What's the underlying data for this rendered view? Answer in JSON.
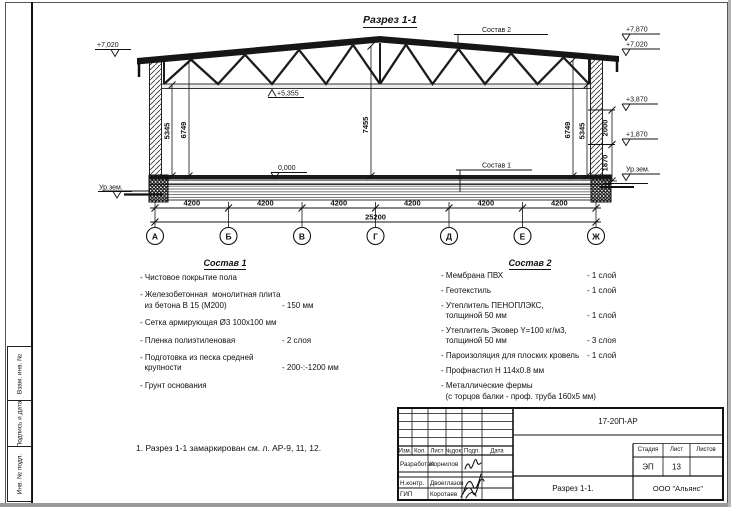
{
  "sheet": {
    "title": "Разрез 1-1",
    "note": "1. Разрез 1-1 замаркирован см. л. АР-9, 11, 12."
  },
  "margin_labels": {
    "vzam": "Взам. инв. №",
    "podpis": "Подпись и дата",
    "inv": "Инв. № подл."
  },
  "drawing": {
    "elevations": {
      "left_top": "+7,020",
      "left_ground": "Ур.зем.",
      "truss_bottom": "+5,355",
      "floor": "0,000",
      "right_ridge": "+7,870",
      "right_eave": "+7,020",
      "right_joint_upper": "+3,870",
      "right_joint_lower": "+1,870",
      "right_ground": "Ур.зем."
    },
    "callouts": {
      "roof": "Состав 2",
      "floor": "Состав 1"
    },
    "vdims": {
      "left_inner": "5345",
      "left_outer": "6749",
      "center": "7455",
      "right_outer": "6749",
      "right_inner": "5345",
      "wall_upper": "2000",
      "wall_lower": "1870"
    },
    "bays": [
      "4200",
      "4200",
      "4200",
      "4200",
      "4200",
      "4200"
    ],
    "total": "25200",
    "axes": [
      "А",
      "Б",
      "В",
      "Г",
      "Д",
      "Е",
      "Ж"
    ]
  },
  "sostav1": {
    "title": "Состав 1",
    "items": [
      {
        "name": "- Чистовое покрытие пола",
        "value": ""
      },
      {
        "name": "- Железобетонная  монолитная плита\n  из бетона В 15 (М200)",
        "value": "- 150 мм"
      },
      {
        "name": "- Сетка армирующая Ø3 100х100 мм",
        "value": ""
      },
      {
        "name": "- Пленка полиэтиленовая",
        "value": "- 2 слоя"
      },
      {
        "name": "- Подготовка из песка средней\n  крупности",
        "value": "- 200-:-1200 мм"
      },
      {
        "name": "- Грунт основания",
        "value": ""
      }
    ]
  },
  "sostav2": {
    "title": "Состав 2",
    "items": [
      {
        "name": "- Мембрана ПВХ",
        "value": "- 1 слой"
      },
      {
        "name": "- Геотекстиль",
        "value": "- 1 слой"
      },
      {
        "name": "- Утеплитель ПЕНОПЛЭКС,\n  толщиной 50 мм",
        "value": "- 1 слой"
      },
      {
        "name": "- Утеплитель Эковер Y=100 кг/м3,\n  толщиной 50 мм",
        "value": "- 3 слоя"
      },
      {
        "name": "- Пароизоляция для плоских кровель",
        "value": "- 1 слой"
      },
      {
        "name": "- Профнастил Н 114х0.8 мм",
        "value": ""
      },
      {
        "name": "- Металлические фермы\n  (с торцов балки - проф. труба 160х5 мм)",
        "value": ""
      }
    ]
  },
  "titleblock": {
    "doc_number": "17-20П-АР",
    "headers": [
      "Изм.",
      "Кол.",
      "Лист",
      "№док.",
      "Подп.",
      "Дата"
    ],
    "rows": [
      {
        "role": "Разработал",
        "name": "Корнилов"
      },
      {
        "role": "Н.контр.",
        "name": "Двоеглазов"
      },
      {
        "role": "ГИП",
        "name": "Коротаев"
      }
    ],
    "stage_label": "Стадия",
    "sheet_label": "Лист",
    "sheets_label": "Листов",
    "stage": "ЭП",
    "sheet_number": "13",
    "sheets_total": "",
    "drawing_name": "Разрез 1-1.",
    "company": "ООО \"Альянс\""
  }
}
